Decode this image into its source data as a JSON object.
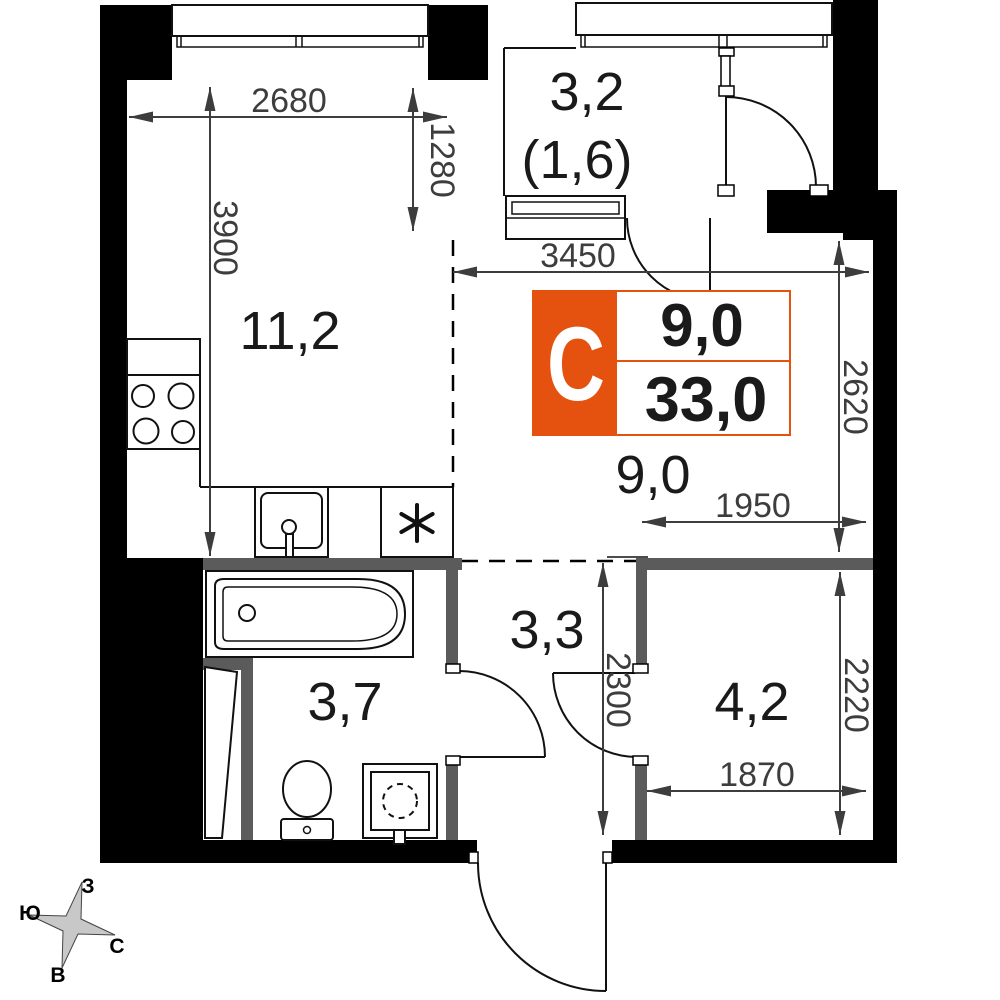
{
  "floor_plan": {
    "room_areas": {
      "kitchen_living": "11,2",
      "loggia_total": "3,2",
      "loggia_counted": "(1,6)",
      "living_zone": "9,0",
      "hallway": "3,3",
      "bathroom": "3,7",
      "storage_room": "4,2"
    },
    "dimensions_mm": {
      "kitchen_width": "2680",
      "niche_depth": "1280",
      "kitchen_length": "3900",
      "living_width": "3450",
      "living_depth": "2620",
      "living_zone_width": "1950",
      "hallway_depth": "2300",
      "storage_depth": "2220",
      "storage_width": "1870"
    },
    "info_badge": {
      "type_letter": "С",
      "living_area": "9,0",
      "total_area": "33,0"
    },
    "compass": {
      "north": "С",
      "south": "Ю",
      "west": "З",
      "east": "В"
    },
    "colors": {
      "accent_orange": "#e5520f",
      "wall_black": "#000000",
      "wall_gray": "#5b5b5b",
      "dimension_gray": "#3d3d3d"
    }
  }
}
